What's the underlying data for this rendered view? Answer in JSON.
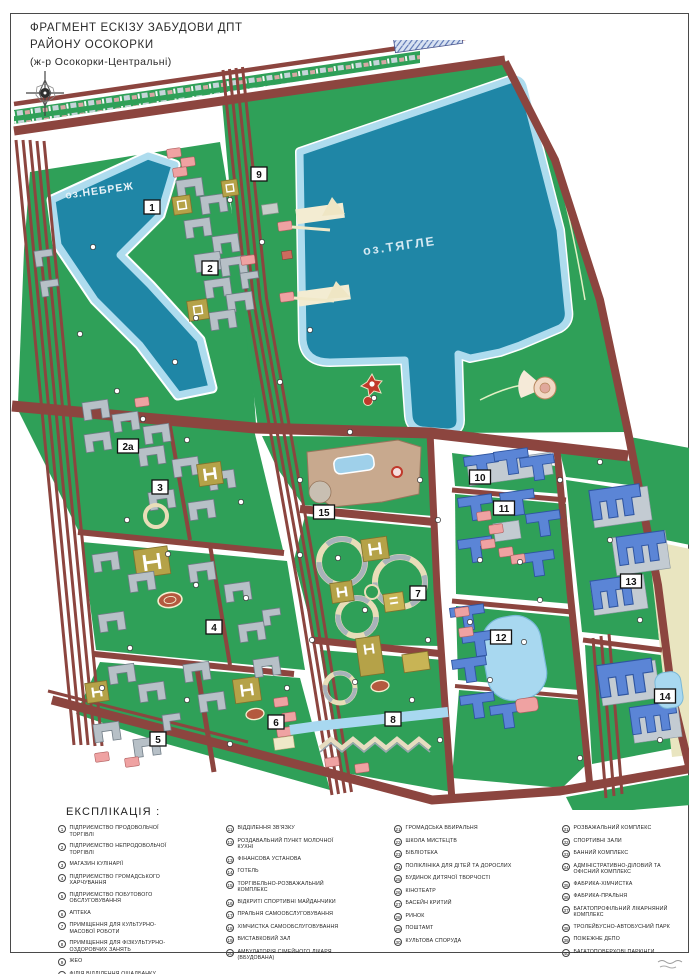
{
  "title": {
    "line1": "ФРАГМЕНТ ЕСКІЗУ ЗАБУДОВИ ДПТ",
    "line2": "РАЙОНУ ОСОКОРКИ",
    "line3": "(ж-р Осокорки-Центральні)"
  },
  "map": {
    "lakes": [
      {
        "name": "оз.НЕБРЕЖ"
      },
      {
        "name": "оз.ТЯГЛЕ"
      }
    ],
    "markers": [
      {
        "label": "1"
      },
      {
        "label": "2"
      },
      {
        "label": "2а"
      },
      {
        "label": "3"
      },
      {
        "label": "4"
      },
      {
        "label": "5"
      },
      {
        "label": "6"
      },
      {
        "label": "7"
      },
      {
        "label": "8"
      },
      {
        "label": "9"
      },
      {
        "label": "10"
      },
      {
        "label": "11"
      },
      {
        "label": "12"
      },
      {
        "label": "13"
      },
      {
        "label": "14"
      },
      {
        "label": "15"
      }
    ]
  },
  "legend": {
    "heading": "ЕКСПЛІКАЦІЯ :",
    "items": [
      {
        "num": "1",
        "label": "ПІДПРИЄМСТВО ПРОДОВОЛЬЧОЇ ТОРГІВЛІ"
      },
      {
        "num": "2",
        "label": "ПІДПРИЄМСТВО НЕПРОДОВОЛЬЧОЇ ТОРГІВЛІ"
      },
      {
        "num": "3",
        "label": "МАГАЗИН КУЛІНАРІЇ"
      },
      {
        "num": "4",
        "label": "ПІДПРИЄМСТВО ГРОМАДСЬКОГО ХАРЧУВАННЯ"
      },
      {
        "num": "5",
        "label": "ПІДПРИЄМСТВО ПОБУТОВОГО ОБСЛУГОВУВАННЯ"
      },
      {
        "num": "6",
        "label": "АПТЕКА"
      },
      {
        "num": "7",
        "label": "ПРИМІЩЕННЯ ДЛЯ КУЛЬТУРНО-МАСОВОЇ РОБОТИ"
      },
      {
        "num": "8",
        "label": "ПРИМІЩЕННЯ ДЛЯ ФІЗКУЛЬТУРНО-ОЗДОРОВЧИХ ЗАНЯТЬ"
      },
      {
        "num": "9",
        "label": "ЖЕО"
      },
      {
        "num": "10",
        "label": "ФІЛІЯ ВІДДІЛЕННЯ ОЩАДБАНКУ"
      },
      {
        "num": "11",
        "label": "ВІДДІЛЕННЯ ЗВ'ЯЗКУ"
      },
      {
        "num": "12",
        "label": "РОЗДАВАЛЬНИЙ ПУНКТ МОЛОЧНОЇ КУХНІ"
      },
      {
        "num": "13",
        "label": "ФІНАНСОВА УСТАНОВА"
      },
      {
        "num": "14",
        "label": "ГОТЕЛЬ"
      },
      {
        "num": "15",
        "label": "ТОРГІВЕЛЬНО-РОЗВАЖАЛЬНИЙ КОМПЛЕКС"
      },
      {
        "num": "16",
        "label": "ВІДКРИТІ СПОРТИВНІ МАЙДАНЧИКИ"
      },
      {
        "num": "17",
        "label": "ПРАЛЬНЯ САМООБСЛУГОВУВАННЯ"
      },
      {
        "num": "18",
        "label": "ХІМЧИСТКА САМООБСЛУГОВУВАННЯ"
      },
      {
        "num": "19",
        "label": "ВИСТАВКОВИЙ ЗАЛ"
      },
      {
        "num": "20",
        "label": "АМБУЛАТОРІЯ СІМЕЙНОГО ЛІКАРЯ (ВБУДОВАНА)"
      },
      {
        "num": "21",
        "label": "ГРОМАДСЬКА ВБИРАЛЬНЯ"
      },
      {
        "num": "22",
        "label": "ШКОЛА МИСТЕЦТВ"
      },
      {
        "num": "23",
        "label": "БІБЛІОТЕКА"
      },
      {
        "num": "24",
        "label": "ПОЛІКЛІНІКА ДЛЯ ДІТЕЙ ТА ДОРОСЛИХ"
      },
      {
        "num": "25",
        "label": "БУДИНОК ДИТЯЧОЇ ТВОРЧОСТІ"
      },
      {
        "num": "26",
        "label": "КІНОТЕАТР"
      },
      {
        "num": "27",
        "label": "БАСЕЙН КРИТИЙ"
      },
      {
        "num": "28",
        "label": "РИНОК"
      },
      {
        "num": "29",
        "label": "ПОШТАМТ"
      },
      {
        "num": "30",
        "label": "КУЛЬТОВА СПОРУДА"
      },
      {
        "num": "31",
        "label": "РОЗВАЖАЛЬНИЙ КОМПЛЕКС"
      },
      {
        "num": "32",
        "label": "СПОРТИВНІ ЗАЛИ"
      },
      {
        "num": "33",
        "label": "БАННИЙ КОМПЛЕКС"
      },
      {
        "num": "34",
        "label": "АДМІНІСТРАТИВНО-ДІЛОВИЙ ТА ОФІСНИЙ КОМПЛЕКС"
      },
      {
        "num": "35",
        "label": "ФАБРИКА-ХІМЧИСТКА"
      },
      {
        "num": "36",
        "label": "ФАБРИКА-ПРАЛЬНЯ"
      },
      {
        "num": "37",
        "label": "БАГАТОПРОФІЛЬНИЙ ЛІКАРНЯНИЙ КОМПЛЕКС"
      },
      {
        "num": "38",
        "label": "ТРОЛЕЙБУСНО-АВТОБУСНИЙ ПАРК"
      },
      {
        "num": "39",
        "label": "ПОЖЕЖНЕ ДЕПО"
      },
      {
        "num": "40",
        "label": "БАГАТОПОВЕРХОВІ ПАРКІНГИ"
      }
    ]
  },
  "colors": {
    "park_green": "#2fa058",
    "water": "#1f86a6",
    "water_rim": "#aedcee",
    "road": "#8c453f",
    "residential_gray": "#b7c0c7",
    "school_khaki": "#b5a248",
    "commercial_pink": "#efa2a2",
    "highrise_blue": "#5b85d6",
    "mall_tan": "#c8a98e",
    "reserve_hatch": "#5570b0"
  }
}
